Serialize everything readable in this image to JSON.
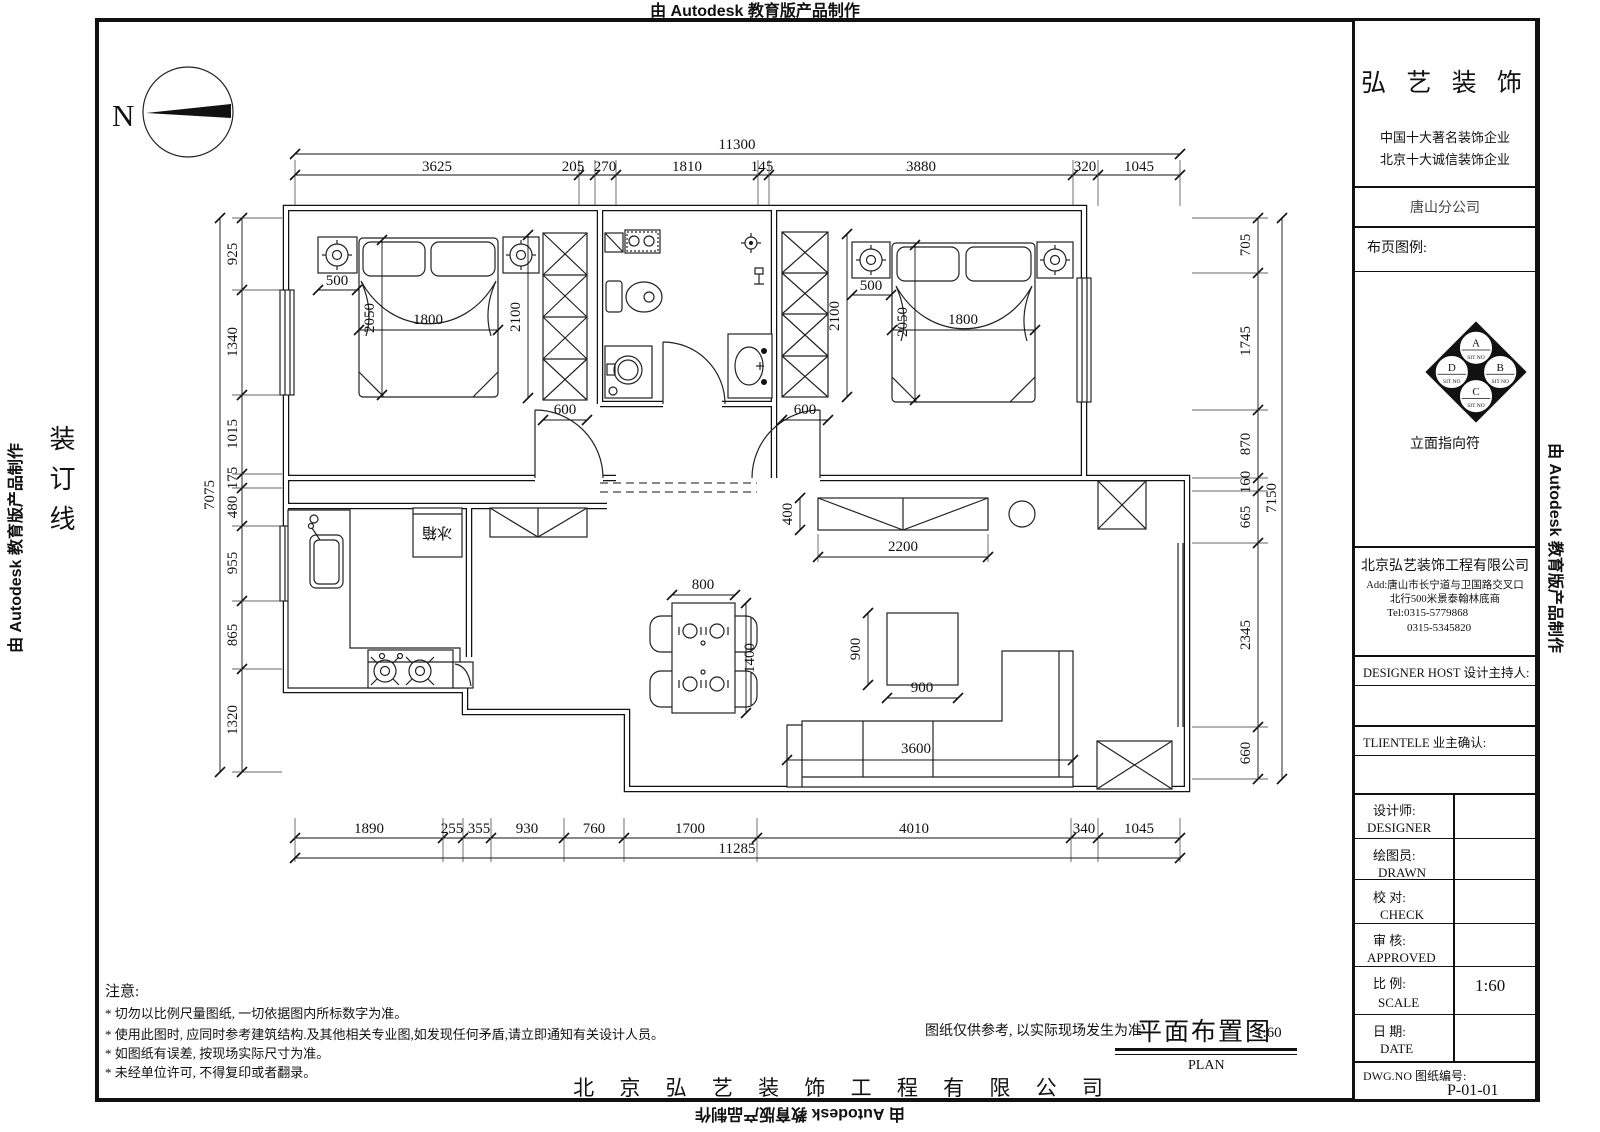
{
  "edge_labels": {
    "top": "由 Autodesk 教育版产品制作",
    "bottom": "由 Autodesk 教育版产品制作",
    "left": "由 Autodesk 教育版产品制作",
    "right": "由 Autodesk 教育版产品制作",
    "binding": "装订线"
  },
  "compass": {
    "n": "N"
  },
  "title_block": {
    "brand": "弘 艺 装 饰",
    "slogan1": "中国十大著名装饰企业",
    "slogan2": "北京十大诚信装饰企业",
    "branch": "唐山分公司",
    "legend_header": "布页图例:",
    "elevation_symbol": {
      "a": "A",
      "b": "B",
      "c": "C",
      "d": "D",
      "sit": "SIT NO",
      "caption": "立面指向符"
    },
    "company": "北京弘艺装饰工程有限公司",
    "address1": "Add:唐山市长宁道与卫国路交叉口",
    "address2": "北行500米景泰翰林底商",
    "tel1": "Tel:0315-5779868",
    "tel2": "0315-5345820",
    "designer_host": "DESIGNER HOST   设计主持人:",
    "client_confirm": "TLIENTELE   业主确认:",
    "rows": [
      {
        "cn": "设计师:",
        "en": "DESIGNER",
        "value": ""
      },
      {
        "cn": "绘图员:",
        "en": "DRAWN",
        "value": ""
      },
      {
        "cn": "校  对:",
        "en": "CHECK",
        "value": ""
      },
      {
        "cn": "审  核:",
        "en": "APPROVED",
        "value": ""
      },
      {
        "cn": "比  例:",
        "en": "SCALE",
        "value": "1:60"
      },
      {
        "cn": "日  期:",
        "en": "DATE",
        "value": ""
      }
    ],
    "dwg_label": "DWG.NO   图纸编号:",
    "dwg_no": "P-01-01"
  },
  "footer": {
    "notes_title": "注意:",
    "notes": [
      "* 切勿以比例尺量图纸, 一切依据图内所标数字为准。",
      "* 使用此图时, 应同时参考建筑结构.及其他相关专业图,如发现任何矛盾,请立即通知有关设计人员。",
      "* 如图纸有误差, 按现场实际尺寸为准。",
      "* 未经单位许可, 不得复印或者翻录。"
    ],
    "disclaimer": "图纸仅供参考, 以实际现场发生为准",
    "drawing_title": "平面布置图",
    "drawing_scale": "1:60",
    "drawing_title_en": "PLAN",
    "company_full": "北 京 弘 艺 装 饰 工 程 有 限 公 司"
  },
  "plan": {
    "labels": {
      "fridge": "冰箱"
    },
    "dims": {
      "top_total": "11300",
      "top": [
        "3625",
        "205",
        "270",
        "1810",
        "145",
        "3880",
        "320",
        "1045"
      ],
      "bottom": [
        "1890",
        "255",
        "355",
        "930",
        "760",
        "1700",
        "4010",
        "340",
        "1045"
      ],
      "bottom_total": "11285",
      "left": [
        "925",
        "1340",
        "1015",
        "175",
        "480",
        "955",
        "865",
        "1320"
      ],
      "left_total": "7075",
      "right": [
        "705",
        "1745",
        "870",
        "160",
        "665",
        "2345",
        "660"
      ],
      "right_total": "7150",
      "br1": {
        "nightstand": "500",
        "bed_width": "1800",
        "bed_length": "2050",
        "wardrobe": "2100",
        "wardrobe_depth": "600"
      },
      "br2": {
        "nightstand": "500",
        "bed_width": "1800",
        "bed_length": "2050",
        "wardrobe": "2100",
        "wardrobe_depth": "600"
      },
      "hall": {
        "cabinet_depth": "400",
        "cabinet_length": "2200"
      },
      "dining": {
        "table_width": "800",
        "table_length": "1400"
      },
      "living": {
        "table_w": "900",
        "table_d": "900",
        "sofa_length": "3600"
      }
    }
  }
}
